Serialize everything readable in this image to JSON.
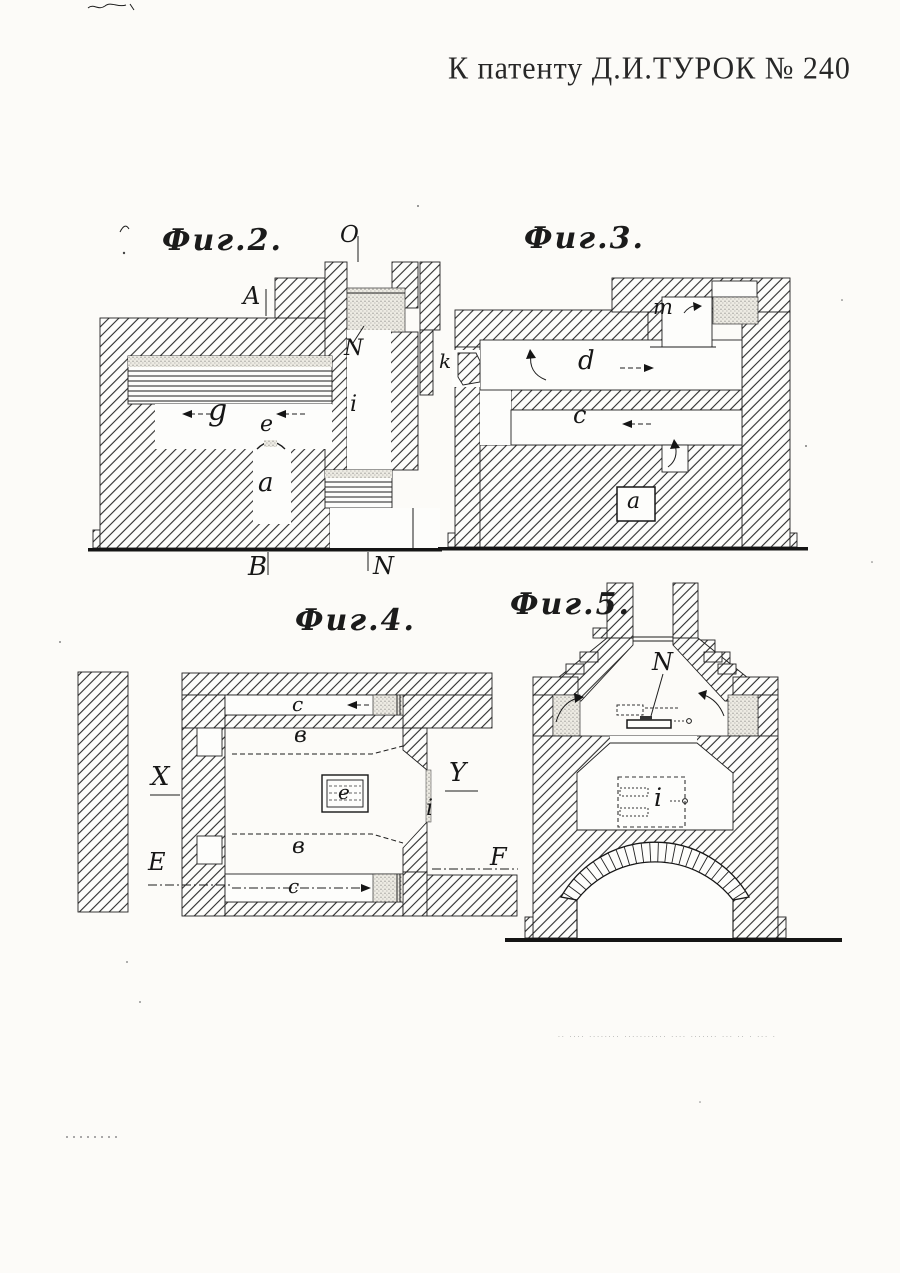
{
  "header": {
    "title": "К патенту Д.И.ТУРОК  № 240"
  },
  "figures": {
    "fig2": {
      "title": "Фиг.2.",
      "labels": {
        "o_section": "O",
        "a_section": "A",
        "n_damper": "N",
        "i": "i",
        "g": "g",
        "e": "e",
        "a": "a",
        "b_section": "B",
        "n_section": "N"
      }
    },
    "fig3": {
      "title": "Фиг.3.",
      "labels": {
        "m": "m",
        "k": "k",
        "d": "d",
        "c": "c",
        "a": "a"
      }
    },
    "fig4": {
      "title": "Фиг.4.",
      "labels": {
        "c_top": "c",
        "v_top": "в",
        "x_section": "X",
        "y_section": "Y",
        "e": "e",
        "i": "i",
        "v_bottom": "в",
        "e_section": "E",
        "f_section": "F",
        "c_bottom": "c"
      }
    },
    "fig5": {
      "title": "Фиг.5.",
      "labels": {
        "n_damper": "N",
        "i": "i"
      }
    }
  },
  "footer": {
    "imprint": "·· ···· ········ ··········· ···· ······· ··· ·· · ··· ·"
  }
}
